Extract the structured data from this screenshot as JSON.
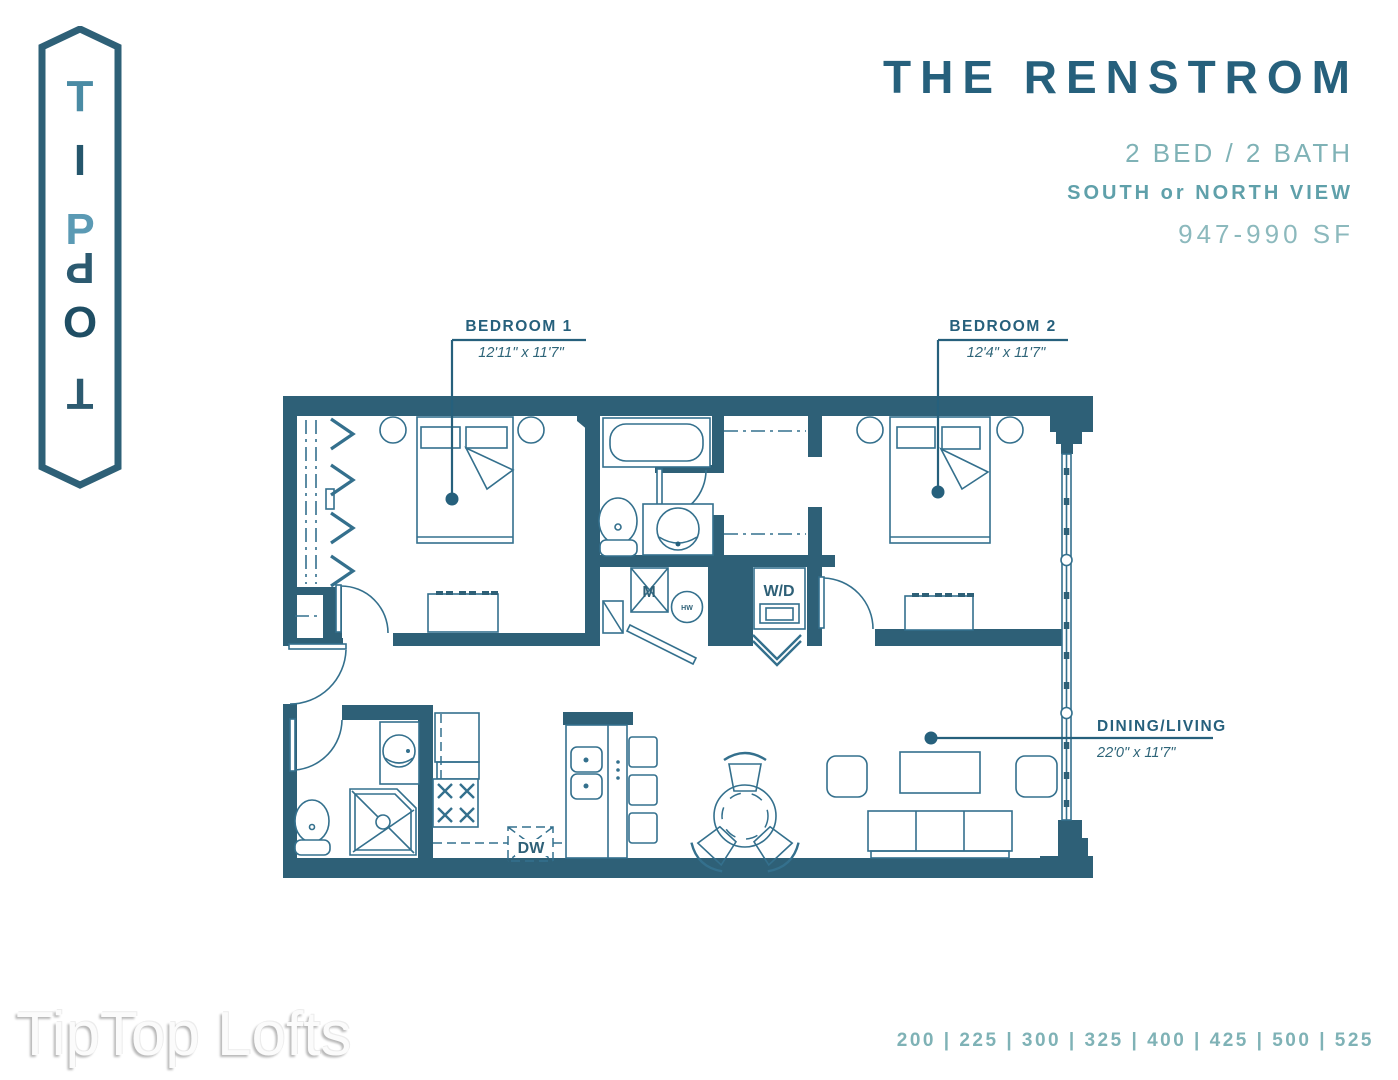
{
  "logo": {
    "letters": [
      "T",
      "I",
      "P",
      "P",
      "O",
      "T"
    ]
  },
  "header": {
    "title": "THE RENSTROM",
    "bed_bath": "2 BED / 2 BATH",
    "view": "SOUTH or NORTH VIEW",
    "sqft": "947-990 SF"
  },
  "plan": {
    "rooms": [
      {
        "label": "BEDROOM 1",
        "dims": "12'11\" x 11'7\""
      },
      {
        "label": "BEDROOM 2",
        "dims": "12'4\" x 11'7\""
      },
      {
        "label": "DINING/LIVING",
        "dims": "22'0\" x 11'7\""
      }
    ],
    "fixtures": {
      "mechanical": "M",
      "hot_water": "HW",
      "washer_dryer": "W/D",
      "dishwasher": "DW"
    }
  },
  "footer": {
    "watermark": "TipTop Lofts",
    "unit_numbers": "200 | 225 | 300 | 325 | 400 | 425 | 500 | 525"
  },
  "colors": {
    "wall": "#2e6077",
    "furniture_line": "#34708d",
    "label": "#26607c",
    "accent_light": "#7fb2b6",
    "accent_mid": "#5fa0aa",
    "accent_pale": "#8cb9bd"
  }
}
